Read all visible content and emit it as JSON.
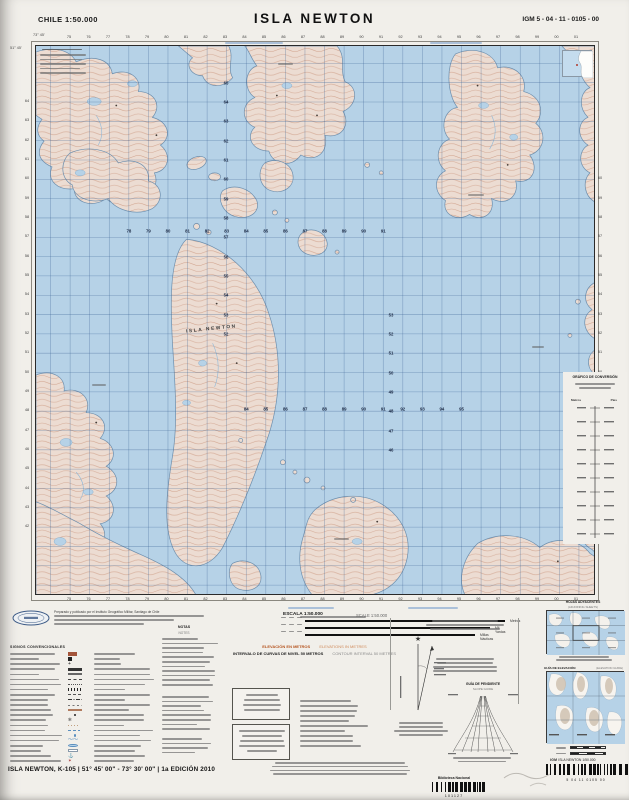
{
  "header": {
    "country_scale": "CHILE 1:50.000",
    "title": "ISLA NEWTON",
    "sheet_code": "IGM 5 - 04 - 11 - 0105 - 00"
  },
  "map": {
    "island_label": "ISLA NEWTON",
    "corner_long_top_left": "73° 45'",
    "corner_lat_left_top": "51° 45'",
    "grid": {
      "top_edge": [
        "75",
        "76",
        "77",
        "78",
        "79",
        "80",
        "81",
        "82",
        "83",
        "84",
        "85",
        "86",
        "87",
        "88",
        "89",
        "90",
        "91",
        "92",
        "93",
        "94",
        "95",
        "96",
        "97",
        "98",
        "99",
        "00",
        "01"
      ],
      "bottom_edge": [
        "75",
        "76",
        "77",
        "78",
        "79",
        "80",
        "81",
        "82",
        "83",
        "84",
        "85",
        "86",
        "87",
        "88",
        "89",
        "90",
        "91",
        "92",
        "93",
        "94",
        "95",
        "96",
        "97",
        "98",
        "99",
        "00",
        "01"
      ],
      "left_edge": [
        "64",
        "63",
        "62",
        "61",
        "60",
        "59",
        "58",
        "57",
        "56",
        "55",
        "54",
        "53",
        "52",
        "51",
        "50",
        "49",
        "48",
        "47",
        "46",
        "45",
        "44",
        "43",
        "42"
      ],
      "right_edge": [
        "60",
        "59",
        "58",
        "57",
        "56",
        "55",
        "54",
        "53",
        "52",
        "51",
        "50",
        "49",
        "48",
        "47",
        "46"
      ],
      "eastings_row1": [
        "78",
        "79",
        "80",
        "81",
        "82",
        "83",
        "84",
        "85",
        "86",
        "87",
        "88",
        "89",
        "90",
        "91"
      ],
      "eastings_row2": [
        "84",
        "85",
        "86",
        "87",
        "88",
        "89",
        "90",
        "91",
        "92",
        "93",
        "94",
        "95"
      ],
      "northings_col1": [
        "65",
        "64",
        "63",
        "62",
        "61",
        "60",
        "59",
        "58",
        "57",
        "56",
        "55",
        "54",
        "53",
        "52"
      ],
      "northings_col2": [
        "53",
        "52",
        "51",
        "50",
        "49",
        "48",
        "47",
        "46"
      ]
    }
  },
  "conversion_graph": {
    "title": "GRÁFICO DE CONVERSIÓN",
    "col_metros": "Metros",
    "col_pies": "Pies"
  },
  "legend": {
    "publisher_line": "Preparado y publicado por el Instituto Geográfico Militar, Santiago de Chile",
    "signos_title": "SIGNOS CONVENCIONALES",
    "signos_rows": [
      "brown-swatch",
      "building",
      "church",
      "road-primary",
      "road-secondary",
      "road-track",
      "trail",
      "railway",
      "power-line",
      "boundary-international",
      "fence",
      "contour-index",
      "spot-elevation",
      "rock",
      "sand",
      "marsh",
      "spring",
      "stream",
      "lake",
      "glacier",
      "anchorage",
      "lighthouse"
    ],
    "notas": "NOTAS",
    "notes_en": "NOTES",
    "escala": "ESCALA 1:50.000",
    "scale_en": "SCALE 1:50.000",
    "scalebar_labels": [
      "Metros",
      "Mil. Yardas",
      "Millas Náuticas"
    ],
    "elev_es": "ELEVACIÓN EN METROS",
    "elev_en": "ELEVATIONS IN METRES",
    "interval_es": "INTERVALO DE CURVAS DE NIVEL 50 METROS",
    "interval_en": "CONTOUR INTERVAL 50 METRES",
    "slope_title": "GUÍA DE PENDIENTE",
    "slope_sub": "SLOPE GUIDE",
    "adjoining_title": "HOJAS ADYACENTES",
    "adjoining_sub": "(ADJOINING SHEETS)",
    "elev_guide_title": "GUÍA DE ELEVACIÓN",
    "elev_guide_sub": "(ELEVATION GUIDE)"
  },
  "footer": {
    "sheet_line": "ISLA NEWTON, K-105  |  51° 45' 00\" - 73° 30' 00\"  |  1a EDICIÓN 2010",
    "igm_word": "IGM",
    "igm_map_ref": "ISLA NEWTON   1/50.000",
    "barcode_digits": "5    04    11    0105    00",
    "library_label": "Biblioteca Nacional",
    "library_number": "101127"
  },
  "colors": {
    "water": "#b6d2e7",
    "land": "#ecdcd2",
    "contour": "#c9947c",
    "grid_blue": "#3c6496",
    "elevation_orange": "#b5541f"
  }
}
